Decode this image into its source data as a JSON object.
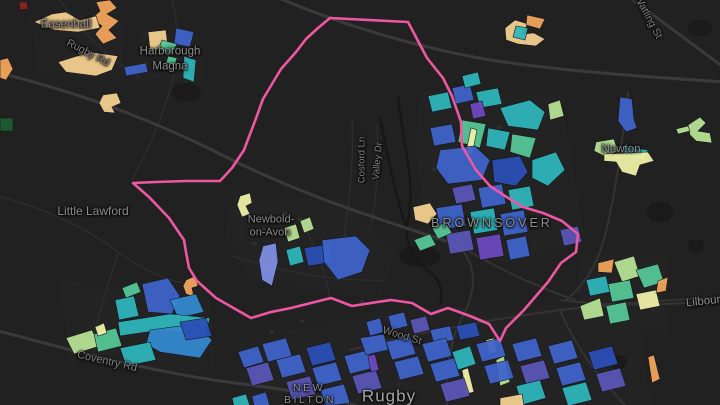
{
  "labels": {
    "easenhall": {
      "text": "Easenhall"
    },
    "harborough_1": {
      "text": "Harborough"
    },
    "harborough_2": {
      "text": "Magna"
    },
    "little_lawford": {
      "text": "Little Lawford"
    },
    "newbold_1": {
      "text": "Newbold-"
    },
    "newbold_2": {
      "text": "on-Avon"
    },
    "brownsover": {
      "text": "BROWNSOVER"
    },
    "newton": {
      "text": "Newton"
    },
    "new_bilton_1": {
      "text": "NEW"
    },
    "new_bilton_2": {
      "text": "BILTON"
    },
    "rugby_town": {
      "text": "Rugby"
    },
    "lilbourne": {
      "text": "Lilbourne"
    },
    "rugby_rd": {
      "text": "Rugby Rd"
    },
    "watling_st": {
      "text": "Watling St"
    },
    "cosford_ln": {
      "text": "Cosford Ln"
    },
    "valley_dr": {
      "text": "Valley Dr"
    },
    "wood_st": {
      "text": "Wood St"
    },
    "coventry_rd": {
      "text": "Coventry Rd"
    }
  },
  "overlay": {
    "boundary": {
      "color": "#ee57a3",
      "width": 2.6,
      "points": "330,18 408,22 427,58 443,78 452,96 461,122 462,146 476,170 490,186 505,196 523,207 543,213 562,221 578,234 576,252 561,263 548,282 524,310 506,328 500,341 489,324 470,316 448,308 431,314 412,303 391,300 371,303 352,306 331,298 311,303 291,308 271,312 251,318 216,298 197,281 189,268 186,252 184,240 169,218 149,197 133,183 156,182 186,181 220,181 232,168 244,150 255,121 263,99 281,69 296,52 306,39 318,28 330,18"
    },
    "palette": {
      "orange": "#f0a45c",
      "tan": "#f3cf8e",
      "yellow": "#eef0a6",
      "lgreen": "#b6e294",
      "green": "#55c695",
      "teal": "#2eb5ba",
      "steel": "#3489cf",
      "blue": "#3e63c9",
      "dblue": "#2b4fb4",
      "indigo": "#5b55b5",
      "purple": "#6d49bf",
      "periwinkle": "#7f8fe2",
      "red": "#8e2525",
      "dgreen": "#1e5c33"
    },
    "polygons": [
      {
        "c": "orange",
        "p": "96,2 110,0 117,8 107,14 119,21 109,30 117,38 103,44 95,34 102,26 91,19 100,11"
      },
      {
        "c": "red",
        "p": "19,2 27,2 28,9 20,10"
      },
      {
        "c": "tan",
        "p": "34,22 52,14 66,12 80,20 96,16 100,28 78,32 54,30"
      },
      {
        "c": "tan",
        "p": "58,62 90,52 118,56 112,70 96,76 66,72"
      },
      {
        "c": "orange",
        "p": "0,60 8,58 13,69 6,80 0,78"
      },
      {
        "c": "dgreen",
        "p": "0,118 13,118 13,131 0,131"
      },
      {
        "c": "tan",
        "p": "103,95 117,93 121,103 112,107 115,113 104,112 99,103"
      },
      {
        "c": "tan",
        "p": "148,32 166,30 168,48 150,50"
      },
      {
        "c": "blue",
        "p": "176,28 194,32 190,47 174,44"
      },
      {
        "c": "green",
        "p": "162,40 177,44 172,54 158,50"
      },
      {
        "c": "blue",
        "p": "124,67 146,63 148,72 126,76"
      },
      {
        "c": "teal",
        "p": "184,56 196,60 194,82 183,78"
      },
      {
        "c": "green",
        "p": "168,56 177,58 175,65 166,63"
      },
      {
        "c": "tan",
        "p": "505,28 515,20 528,24 522,34 534,33 545,39 536,46 518,44 506,40"
      },
      {
        "c": "orange",
        "p": "527,15 545,19 540,29 526,25"
      },
      {
        "c": "teal",
        "p": "516,26 528,28 525,40 513,37"
      },
      {
        "c": "blue",
        "p": "620,97 632,99 634,119 637,128 626,132 618,121"
      },
      {
        "c": "lgreen",
        "p": "596,142 614,139 618,151 606,157 594,151"
      },
      {
        "c": "teal",
        "p": "622,146 648,150 644,160 624,156"
      },
      {
        "c": "yellow",
        "p": "604,154 648,152 654,161 640,165 636,176 622,172 616,162 604,161"
      },
      {
        "c": "lgreen",
        "p": "688,125 700,117 706,123 698,131 710,133 712,143 696,141 690,135"
      },
      {
        "c": "lgreen",
        "p": "676,129 688,126 690,131 678,134"
      },
      {
        "c": "teal",
        "p": "428,96 448,92 452,108 432,112"
      },
      {
        "c": "blue",
        "p": "452,88 470,84 474,100 456,104"
      },
      {
        "c": "teal",
        "p": "476,92 498,88 502,104 480,108"
      },
      {
        "c": "purple",
        "p": "470,104 482,101 486,116 473,119"
      },
      {
        "c": "teal",
        "p": "500,108 530,100 545,112 538,130 508,126"
      },
      {
        "c": "lgreen",
        "p": "548,104 560,100 564,116 550,120"
      },
      {
        "c": "green",
        "p": "462,120 486,124 480,148 458,142"
      },
      {
        "c": "yellow",
        "p": "466,152 471,128 477,130 472,155"
      },
      {
        "c": "teal",
        "p": "488,128 510,132 505,150 486,146"
      },
      {
        "c": "green",
        "p": "512,134 536,138 530,158 510,152"
      },
      {
        "c": "blue",
        "p": "430,128 452,124 456,142 434,146"
      },
      {
        "c": "blue",
        "p": "440,150 475,146 490,160 482,180 448,184 436,168"
      },
      {
        "c": "dblue",
        "p": "492,160 520,156 528,172 516,186 494,182"
      },
      {
        "c": "teal",
        "p": "532,160 556,152 565,170 548,186 532,178"
      },
      {
        "c": "indigo",
        "p": "452,188 472,184 476,200 456,204"
      },
      {
        "c": "blue",
        "p": "478,188 502,184 506,204 482,208"
      },
      {
        "c": "teal",
        "p": "508,190 530,186 534,206 512,210"
      },
      {
        "c": "blue",
        "p": "436,208 462,204 466,226 440,230"
      },
      {
        "c": "teal",
        "p": "470,212 494,208 498,230 474,234"
      },
      {
        "c": "blue",
        "p": "500,214 524,210 528,232 504,236"
      },
      {
        "c": "indigo",
        "p": "446,234 470,230 474,250 450,254"
      },
      {
        "c": "purple",
        "p": "476,238 500,234 504,256 480,260"
      },
      {
        "c": "blue",
        "p": "506,240 526,236 530,256 510,260"
      },
      {
        "c": "tan",
        "p": "413,207 430,203 437,214 428,224 415,220"
      },
      {
        "c": "teal",
        "p": "462,76 478,72 481,84 465,88"
      },
      {
        "c": "indigo",
        "p": "560,230 578,226 582,242 564,246"
      },
      {
        "c": "green",
        "p": "414,240 430,234 436,245 420,251"
      },
      {
        "c": "green",
        "p": "432,228 446,222 452,233 438,239"
      },
      {
        "c": "yellow",
        "p": "240,196 250,193 252,203 246,206 250,214 242,217 237,205"
      },
      {
        "c": "lgreen",
        "p": "284,228 296,224 300,238 288,242"
      },
      {
        "c": "lgreen",
        "p": "300,221 310,217 314,229 304,233"
      },
      {
        "c": "periwinkle",
        "p": "263,246 276,243 278,262 272,286 262,280 259,260"
      },
      {
        "c": "teal",
        "p": "286,250 300,246 304,262 290,266"
      },
      {
        "c": "dblue",
        "p": "304,248 330,244 334,262 308,266"
      },
      {
        "c": "blue",
        "p": "322,240 356,236 370,250 362,272 338,280 324,262"
      },
      {
        "c": "orange",
        "p": "186,280 195,276 198,286 192,288 194,297 186,294 183,286"
      },
      {
        "c": "green",
        "p": "122,288 137,282 141,292 126,298"
      },
      {
        "c": "teal",
        "p": "115,300 134,296 139,316 119,320"
      },
      {
        "c": "blue",
        "p": "142,284 168,278 180,296 172,314 148,312"
      },
      {
        "c": "steel",
        "p": "170,300 196,294 204,312 178,318"
      },
      {
        "c": "teal",
        "p": "118,322 170,314 210,318 206,334 160,330 120,336"
      },
      {
        "c": "steel",
        "p": "150,330 196,324 212,340 200,358 160,352 146,344"
      },
      {
        "c": "lgreen",
        "p": "66,338 92,330 100,346 74,354"
      },
      {
        "c": "green",
        "p": "94,334 116,328 122,346 98,352"
      },
      {
        "c": "yellow",
        "p": "95,327 104,323 107,333 98,336"
      },
      {
        "c": "teal",
        "p": "120,348 150,342 156,360 126,366"
      },
      {
        "c": "dblue",
        "p": "180,322 206,318 212,336 186,340"
      },
      {
        "c": "orange",
        "p": "598,263 614,259 612,273 598,272"
      },
      {
        "c": "lgreen",
        "p": "614,262 634,256 640,276 622,282"
      },
      {
        "c": "green",
        "p": "636,270 658,264 664,282 644,288"
      },
      {
        "c": "teal",
        "p": "586,280 606,276 610,292 590,296"
      },
      {
        "c": "green",
        "p": "608,284 630,280 634,298 612,302"
      },
      {
        "c": "yellow",
        "p": "636,294 656,290 660,306 640,310"
      },
      {
        "c": "lgreen",
        "p": "580,306 600,298 604,316 584,320"
      },
      {
        "c": "green",
        "p": "606,306 626,302 630,320 610,324"
      },
      {
        "c": "orange",
        "p": "658,281 668,277 666,291 656,293"
      },
      {
        "c": "orange",
        "p": "648,357 654,355 660,379 652,383"
      },
      {
        "c": "blue",
        "p": "238,352 258,346 264,362 244,368"
      },
      {
        "c": "blue",
        "p": "262,344 286,338 292,356 268,362"
      },
      {
        "c": "indigo",
        "p": "246,368 268,362 274,380 252,386"
      },
      {
        "c": "blue",
        "p": "276,360 300,354 306,372 282,378"
      },
      {
        "c": "dblue",
        "p": "306,348 330,342 336,360 312,366"
      },
      {
        "c": "blue",
        "p": "312,368 336,362 342,380 318,386"
      },
      {
        "c": "indigo",
        "p": "286,382 310,376 316,394 292,400"
      },
      {
        "c": "blue",
        "p": "320,390 344,384 350,403 326,406"
      },
      {
        "c": "blue",
        "p": "344,356 368,350 374,368 350,374"
      },
      {
        "c": "indigo",
        "p": "352,376 376,370 382,388 358,394"
      },
      {
        "c": "blue",
        "p": "360,338 384,334 388,350 366,355"
      },
      {
        "c": "purple",
        "p": "368,356 375,354 379,370 371,372"
      },
      {
        "c": "blue",
        "p": "386,342 410,336 416,354 392,360"
      },
      {
        "c": "blue",
        "p": "394,362 418,356 424,374 400,380"
      },
      {
        "c": "blue",
        "p": "366,322 380,318 384,332 370,336"
      },
      {
        "c": "blue",
        "p": "388,316 404,312 408,326 392,330"
      },
      {
        "c": "indigo",
        "p": "410,320 426,316 430,330 414,334"
      },
      {
        "c": "blue",
        "p": "430,330 450,326 454,340 434,344"
      },
      {
        "c": "dblue",
        "p": "456,326 476,322 480,336 460,340"
      },
      {
        "c": "teal",
        "p": "452,352 470,346 476,364 458,370"
      },
      {
        "c": "yellow",
        "p": "462,370 468,368 474,392 466,394"
      },
      {
        "c": "yellow",
        "p": "486,340 494,338 497,352 489,354"
      },
      {
        "c": "lgreen",
        "p": "496,360 504,356 510,382 500,386"
      },
      {
        "c": "blue",
        "p": "422,344 446,338 452,356 428,362"
      },
      {
        "c": "blue",
        "p": "430,364 454,358 460,376 436,382"
      },
      {
        "c": "indigo",
        "p": "440,384 464,378 470,396 446,402"
      },
      {
        "c": "blue",
        "p": "476,344 500,338 506,356 482,362"
      },
      {
        "c": "blue",
        "p": "484,366 508,360 514,378 490,384"
      },
      {
        "c": "blue",
        "p": "512,344 536,338 542,356 518,362"
      },
      {
        "c": "indigo",
        "p": "520,366 544,360 550,378 526,384"
      },
      {
        "c": "teal",
        "p": "516,386 540,380 546,398 522,405"
      },
      {
        "c": "tan",
        "p": "500,398 522,394 524,406 500,406"
      },
      {
        "c": "blue",
        "p": "548,346 572,340 578,358 554,364"
      },
      {
        "c": "blue",
        "p": "556,368 580,362 586,380 562,386"
      },
      {
        "c": "teal",
        "p": "562,388 586,382 592,400 568,406"
      },
      {
        "c": "dblue",
        "p": "588,352 612,346 618,364 594,370"
      },
      {
        "c": "indigo",
        "p": "596,374 620,368 626,386 602,392"
      },
      {
        "c": "teal",
        "p": "232,398 246,394 250,406 234,406"
      },
      {
        "c": "blue",
        "p": "252,396 266,392 270,406 254,406"
      }
    ]
  }
}
